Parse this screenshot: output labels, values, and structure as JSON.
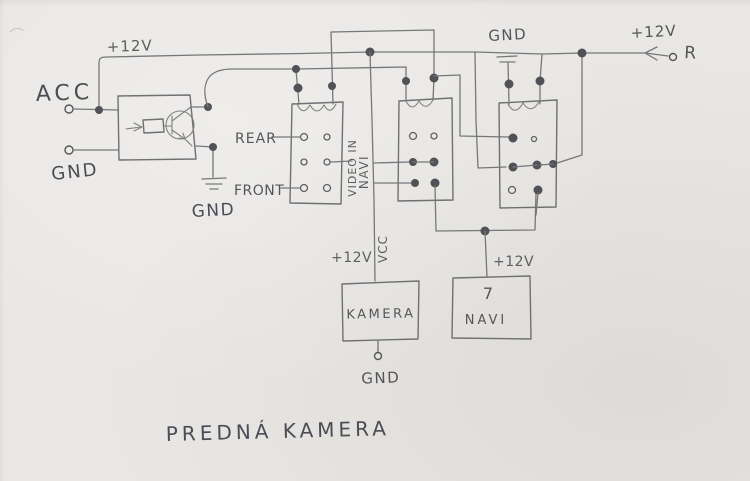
{
  "title": "PREDNÁ KAMERA",
  "colors": {
    "paper": "#e9e7e4",
    "pencil_line": "#76777a",
    "pencil_text": "#5d5e63",
    "ink_text": "#4b4c55",
    "junction_dot": "#515257"
  },
  "power_left": {
    "rail_label": "+12V"
  },
  "inputs": {
    "acc_label": "ACC",
    "gnd_label": "GND"
  },
  "transistor_module": {
    "gnd_label": "GND"
  },
  "relay_block": {
    "rear_label": "REAR",
    "front_label": "FRONT",
    "video_in_line1": "VIDEO IN",
    "video_in_line2": "NAVI"
  },
  "kamera": {
    "supply_label": "+12V",
    "vcc_label": "VCC",
    "name": "KAMERA",
    "gnd_label": "GND"
  },
  "navi": {
    "supply_label": "+12V",
    "pin_label": "7",
    "name": "NAVI"
  },
  "power_right": {
    "gnd_label": "GND",
    "rail_label": "+12V",
    "reverse_label": "R"
  }
}
